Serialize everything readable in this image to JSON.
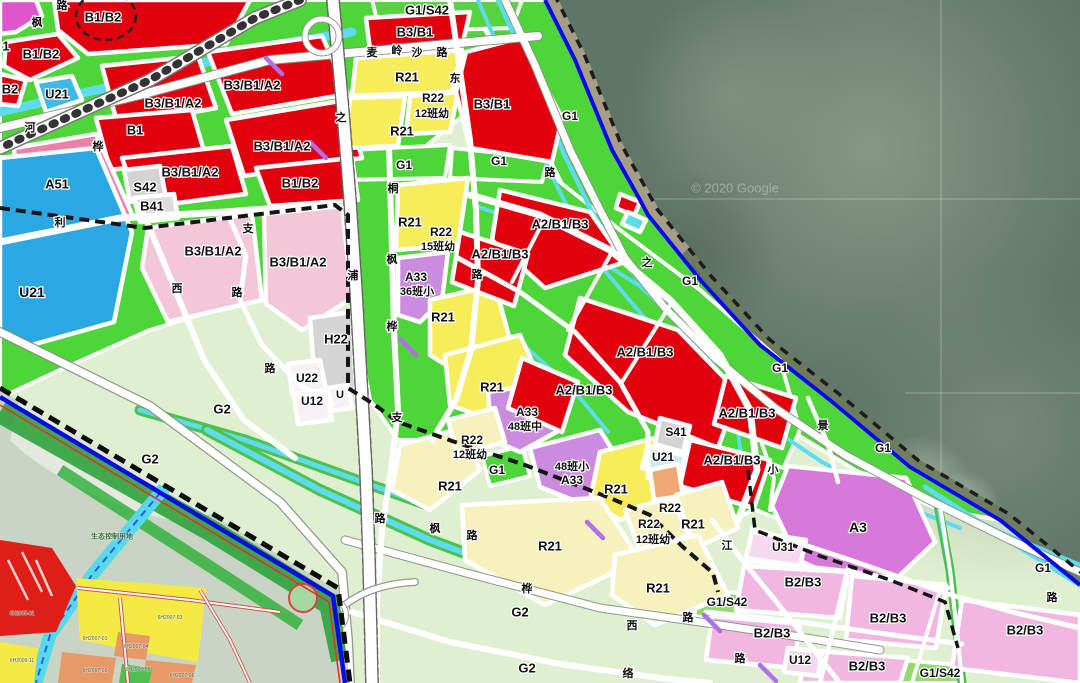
{
  "map": {
    "type": "land-use zoning plan with satellite coastline",
    "watermark": "© 2020 Google",
    "colors": {
      "commercial_red": "#e3000e",
      "residential_yellow": "#f7ec5a",
      "residential_cream": "#f6f1bd",
      "green_space": "#4ed539",
      "pale_green": "#dff0d1",
      "utility_blue": "#2ba7e4",
      "canal_cyan": "#5fdbee",
      "pink_a51": "#ee7fa9",
      "pale_pink": "#f3c6d8",
      "b2b3_pink": "#f2b7e1",
      "school_purple": "#cb8ce0",
      "a3_violet": "#d779da",
      "gray_facility": "#d2d3d2",
      "orange_r22": "#f2a873",
      "water": "#5f7568",
      "boundary_blue": "#0a0ae0"
    },
    "labels": [
      {
        "t": "B1/B2",
        "x": 103,
        "y": 17,
        "s": 13
      },
      {
        "t": "1",
        "x": 6,
        "y": 46,
        "s": 13
      },
      {
        "t": "B1/B2",
        "x": 41,
        "y": 54,
        "s": 13
      },
      {
        "t": "B2",
        "x": 10,
        "y": 89,
        "s": 13
      },
      {
        "t": "U21",
        "x": 57,
        "y": 94,
        "s": 13
      },
      {
        "t": "B3/B1/A2",
        "x": 252,
        "y": 85,
        "s": 13
      },
      {
        "t": "B3/B1/A2",
        "x": 173,
        "y": 103,
        "s": 13
      },
      {
        "t": "B1",
        "x": 135,
        "y": 130,
        "s": 13
      },
      {
        "t": "B3/B1/A2",
        "x": 282,
        "y": 146,
        "s": 13
      },
      {
        "t": "B3/B1/A2",
        "x": 190,
        "y": 172,
        "s": 13
      },
      {
        "t": "B1/B2",
        "x": 300,
        "y": 183,
        "s": 13
      },
      {
        "t": "A51",
        "x": 57,
        "y": 184,
        "s": 13
      },
      {
        "t": "S42",
        "x": 145,
        "y": 187,
        "s": 13
      },
      {
        "t": "B41",
        "x": 152,
        "y": 206,
        "s": 13
      },
      {
        "t": "U21",
        "x": 32,
        "y": 292,
        "s": 14
      },
      {
        "t": "B3/B1/A2",
        "x": 213,
        "y": 251,
        "s": 13
      },
      {
        "t": "B3/B1/A2",
        "x": 298,
        "y": 262,
        "s": 13
      },
      {
        "t": "H22",
        "x": 336,
        "y": 339,
        "s": 13
      },
      {
        "t": "U22",
        "x": 307,
        "y": 378,
        "s": 12
      },
      {
        "t": "U12",
        "x": 312,
        "y": 401,
        "s": 12
      },
      {
        "t": "U",
        "x": 340,
        "y": 394,
        "s": 11
      },
      {
        "t": "G2",
        "x": 222,
        "y": 409,
        "s": 13
      },
      {
        "t": "G2",
        "x": 150,
        "y": 459,
        "s": 13
      },
      {
        "t": "G1/S42",
        "x": 427,
        "y": 10,
        "s": 13
      },
      {
        "t": "B3/B1",
        "x": 415,
        "y": 32,
        "s": 13
      },
      {
        "t": "R21",
        "x": 407,
        "y": 77,
        "s": 13
      },
      {
        "t": "R22",
        "x": 433,
        "y": 98,
        "s": 12
      },
      {
        "t": "12班幼",
        "x": 432,
        "y": 113,
        "s": 11
      },
      {
        "t": "R21",
        "x": 402,
        "y": 131,
        "s": 13
      },
      {
        "t": "B3/B1",
        "x": 492,
        "y": 104,
        "s": 13
      },
      {
        "t": "G1",
        "x": 404,
        "y": 165,
        "s": 12
      },
      {
        "t": "G1",
        "x": 499,
        "y": 161,
        "s": 12
      },
      {
        "t": "G1",
        "x": 570,
        "y": 116,
        "s": 12
      },
      {
        "t": "R21",
        "x": 410,
        "y": 222,
        "s": 13
      },
      {
        "t": "R22",
        "x": 441,
        "y": 232,
        "s": 12
      },
      {
        "t": "15班幼",
        "x": 438,
        "y": 246,
        "s": 11
      },
      {
        "t": "A33",
        "x": 416,
        "y": 277,
        "s": 12
      },
      {
        "t": "36班小",
        "x": 417,
        "y": 291,
        "s": 11
      },
      {
        "t": "R21",
        "x": 443,
        "y": 317,
        "s": 13
      },
      {
        "t": "A2/B1/B3",
        "x": 560,
        "y": 224,
        "s": 13
      },
      {
        "t": "A2/B1/B3",
        "x": 500,
        "y": 254,
        "s": 13
      },
      {
        "t": "A2/B1/B3",
        "x": 645,
        "y": 352,
        "s": 13
      },
      {
        "t": "A2/B1/B3",
        "x": 584,
        "y": 390,
        "s": 13
      },
      {
        "t": "R21",
        "x": 492,
        "y": 387,
        "s": 13
      },
      {
        "t": "A33",
        "x": 527,
        "y": 412,
        "s": 12
      },
      {
        "t": "48班中",
        "x": 525,
        "y": 426,
        "s": 11
      },
      {
        "t": "R22",
        "x": 472,
        "y": 440,
        "s": 12
      },
      {
        "t": "12班幼",
        "x": 470,
        "y": 454,
        "s": 11
      },
      {
        "t": "G1",
        "x": 497,
        "y": 470,
        "s": 12
      },
      {
        "t": "R21",
        "x": 450,
        "y": 486,
        "s": 13
      },
      {
        "t": "48班小",
        "x": 572,
        "y": 466,
        "s": 11
      },
      {
        "t": "A33",
        "x": 572,
        "y": 480,
        "s": 12
      },
      {
        "t": "R21",
        "x": 616,
        "y": 489,
        "s": 13
      },
      {
        "t": "R22",
        "x": 670,
        "y": 508,
        "s": 12
      },
      {
        "t": "R22",
        "x": 649,
        "y": 524,
        "s": 12
      },
      {
        "t": "12班幼",
        "x": 653,
        "y": 539,
        "s": 11
      },
      {
        "t": "R21",
        "x": 693,
        "y": 524,
        "s": 13
      },
      {
        "t": "S41",
        "x": 676,
        "y": 432,
        "s": 12
      },
      {
        "t": "U21",
        "x": 663,
        "y": 457,
        "s": 12
      },
      {
        "t": "A2/B1/B3",
        "x": 732,
        "y": 460,
        "s": 13
      },
      {
        "t": "A2/B1/B3",
        "x": 747,
        "y": 413,
        "s": 13
      },
      {
        "t": "G1",
        "x": 690,
        "y": 281,
        "s": 12
      },
      {
        "t": "G1",
        "x": 780,
        "y": 368,
        "s": 12
      },
      {
        "t": "G1",
        "x": 883,
        "y": 448,
        "s": 12
      },
      {
        "t": "A3",
        "x": 858,
        "y": 527,
        "s": 14
      },
      {
        "t": "U31",
        "x": 783,
        "y": 547,
        "s": 12
      },
      {
        "t": "B2/B3",
        "x": 803,
        "y": 582,
        "s": 13
      },
      {
        "t": "B2/B3",
        "x": 888,
        "y": 618,
        "s": 13
      },
      {
        "t": "B2/B3",
        "x": 772,
        "y": 633,
        "s": 13
      },
      {
        "t": "B2/B3",
        "x": 867,
        "y": 666,
        "s": 13
      },
      {
        "t": "B2/B3",
        "x": 1025,
        "y": 630,
        "s": 13
      },
      {
        "t": "U12",
        "x": 800,
        "y": 660,
        "s": 12
      },
      {
        "t": "G1/S42",
        "x": 727,
        "y": 602,
        "s": 12
      },
      {
        "t": "G1/S42",
        "x": 940,
        "y": 673,
        "s": 12
      },
      {
        "t": "G1",
        "x": 1043,
        "y": 568,
        "s": 12
      },
      {
        "t": "R21",
        "x": 550,
        "y": 546,
        "s": 13
      },
      {
        "t": "R21",
        "x": 658,
        "y": 588,
        "s": 13
      },
      {
        "t": "G2",
        "x": 520,
        "y": 612,
        "s": 13
      },
      {
        "t": "G2",
        "x": 527,
        "y": 668,
        "s": 13
      },
      {
        "t": "生态控制用地",
        "x": 112,
        "y": 536,
        "s": 7,
        "cls": "eco"
      },
      {
        "t": "6H2005-01",
        "x": 22,
        "y": 613,
        "s": 5,
        "cls": "inset"
      },
      {
        "t": "6H2009-11",
        "x": 22,
        "y": 660,
        "s": 5,
        "cls": "inset"
      },
      {
        "t": "6H2007-03",
        "x": 170,
        "y": 617,
        "s": 5,
        "cls": "inset"
      },
      {
        "t": "6H2007-01",
        "x": 95,
        "y": 638,
        "s": 5,
        "cls": "inset"
      },
      {
        "t": "6H2007-04",
        "x": 136,
        "y": 646,
        "s": 5,
        "cls": "inset"
      },
      {
        "t": "6H2007-02",
        "x": 95,
        "y": 670,
        "s": 5,
        "cls": "inset"
      },
      {
        "t": "6H2005-06",
        "x": 138,
        "y": 669,
        "s": 5,
        "cls": "inset"
      },
      {
        "t": "6H2007-06",
        "x": 182,
        "y": 675,
        "s": 5,
        "cls": "inset"
      },
      {
        "t": "© 2020 Google",
        "x": 735,
        "y": 188,
        "s": 13,
        "cls": "wm"
      },
      {
        "t": "路",
        "x": 62,
        "y": 5,
        "s": 11
      },
      {
        "t": "枫",
        "x": 37,
        "y": 22,
        "s": 11
      },
      {
        "t": "河",
        "x": 30,
        "y": 127,
        "s": 11
      },
      {
        "t": "桦",
        "x": 98,
        "y": 146,
        "s": 11
      },
      {
        "t": "利",
        "x": 60,
        "y": 222,
        "s": 11
      },
      {
        "t": "西",
        "x": 177,
        "y": 288,
        "s": 11
      },
      {
        "t": "支",
        "x": 248,
        "y": 228,
        "s": 11
      },
      {
        "t": "路",
        "x": 237,
        "y": 292,
        "s": 11
      },
      {
        "t": "路",
        "x": 270,
        "y": 368,
        "s": 11
      },
      {
        "t": "浦",
        "x": 353,
        "y": 275,
        "s": 11
      },
      {
        "t": "桐",
        "x": 393,
        "y": 188,
        "s": 11
      },
      {
        "t": "枫",
        "x": 392,
        "y": 259,
        "s": 11
      },
      {
        "t": "路",
        "x": 477,
        "y": 274,
        "s": 11
      },
      {
        "t": "桦",
        "x": 392,
        "y": 326,
        "s": 11
      },
      {
        "t": "支",
        "x": 397,
        "y": 417,
        "s": 11
      },
      {
        "t": "路",
        "x": 380,
        "y": 518,
        "s": 11
      },
      {
        "t": "东",
        "x": 455,
        "y": 78,
        "s": 11
      },
      {
        "t": "路",
        "x": 550,
        "y": 172,
        "s": 11
      },
      {
        "t": "麦",
        "x": 372,
        "y": 52,
        "s": 11
      },
      {
        "t": "岭",
        "x": 397,
        "y": 50,
        "s": 11
      },
      {
        "t": "沙",
        "x": 417,
        "y": 52,
        "s": 11
      },
      {
        "t": "路",
        "x": 442,
        "y": 52,
        "s": 11
      },
      {
        "t": "之",
        "x": 341,
        "y": 117,
        "s": 11
      },
      {
        "t": "之",
        "x": 647,
        "y": 262,
        "s": 11
      },
      {
        "t": "景",
        "x": 823,
        "y": 425,
        "s": 11
      },
      {
        "t": "小",
        "x": 773,
        "y": 469,
        "s": 11
      },
      {
        "t": "江",
        "x": 727,
        "y": 545,
        "s": 11
      },
      {
        "t": "枫",
        "x": 435,
        "y": 528,
        "s": 11
      },
      {
        "t": "路",
        "x": 472,
        "y": 535,
        "s": 11
      },
      {
        "t": "桦",
        "x": 527,
        "y": 588,
        "s": 11
      },
      {
        "t": "西",
        "x": 632,
        "y": 625,
        "s": 11
      },
      {
        "t": "路",
        "x": 688,
        "y": 617,
        "s": 11
      },
      {
        "t": "路",
        "x": 740,
        "y": 658,
        "s": 11
      },
      {
        "t": "络",
        "x": 628,
        "y": 673,
        "s": 11
      },
      {
        "t": "路",
        "x": 1052,
        "y": 597,
        "s": 11
      }
    ]
  }
}
